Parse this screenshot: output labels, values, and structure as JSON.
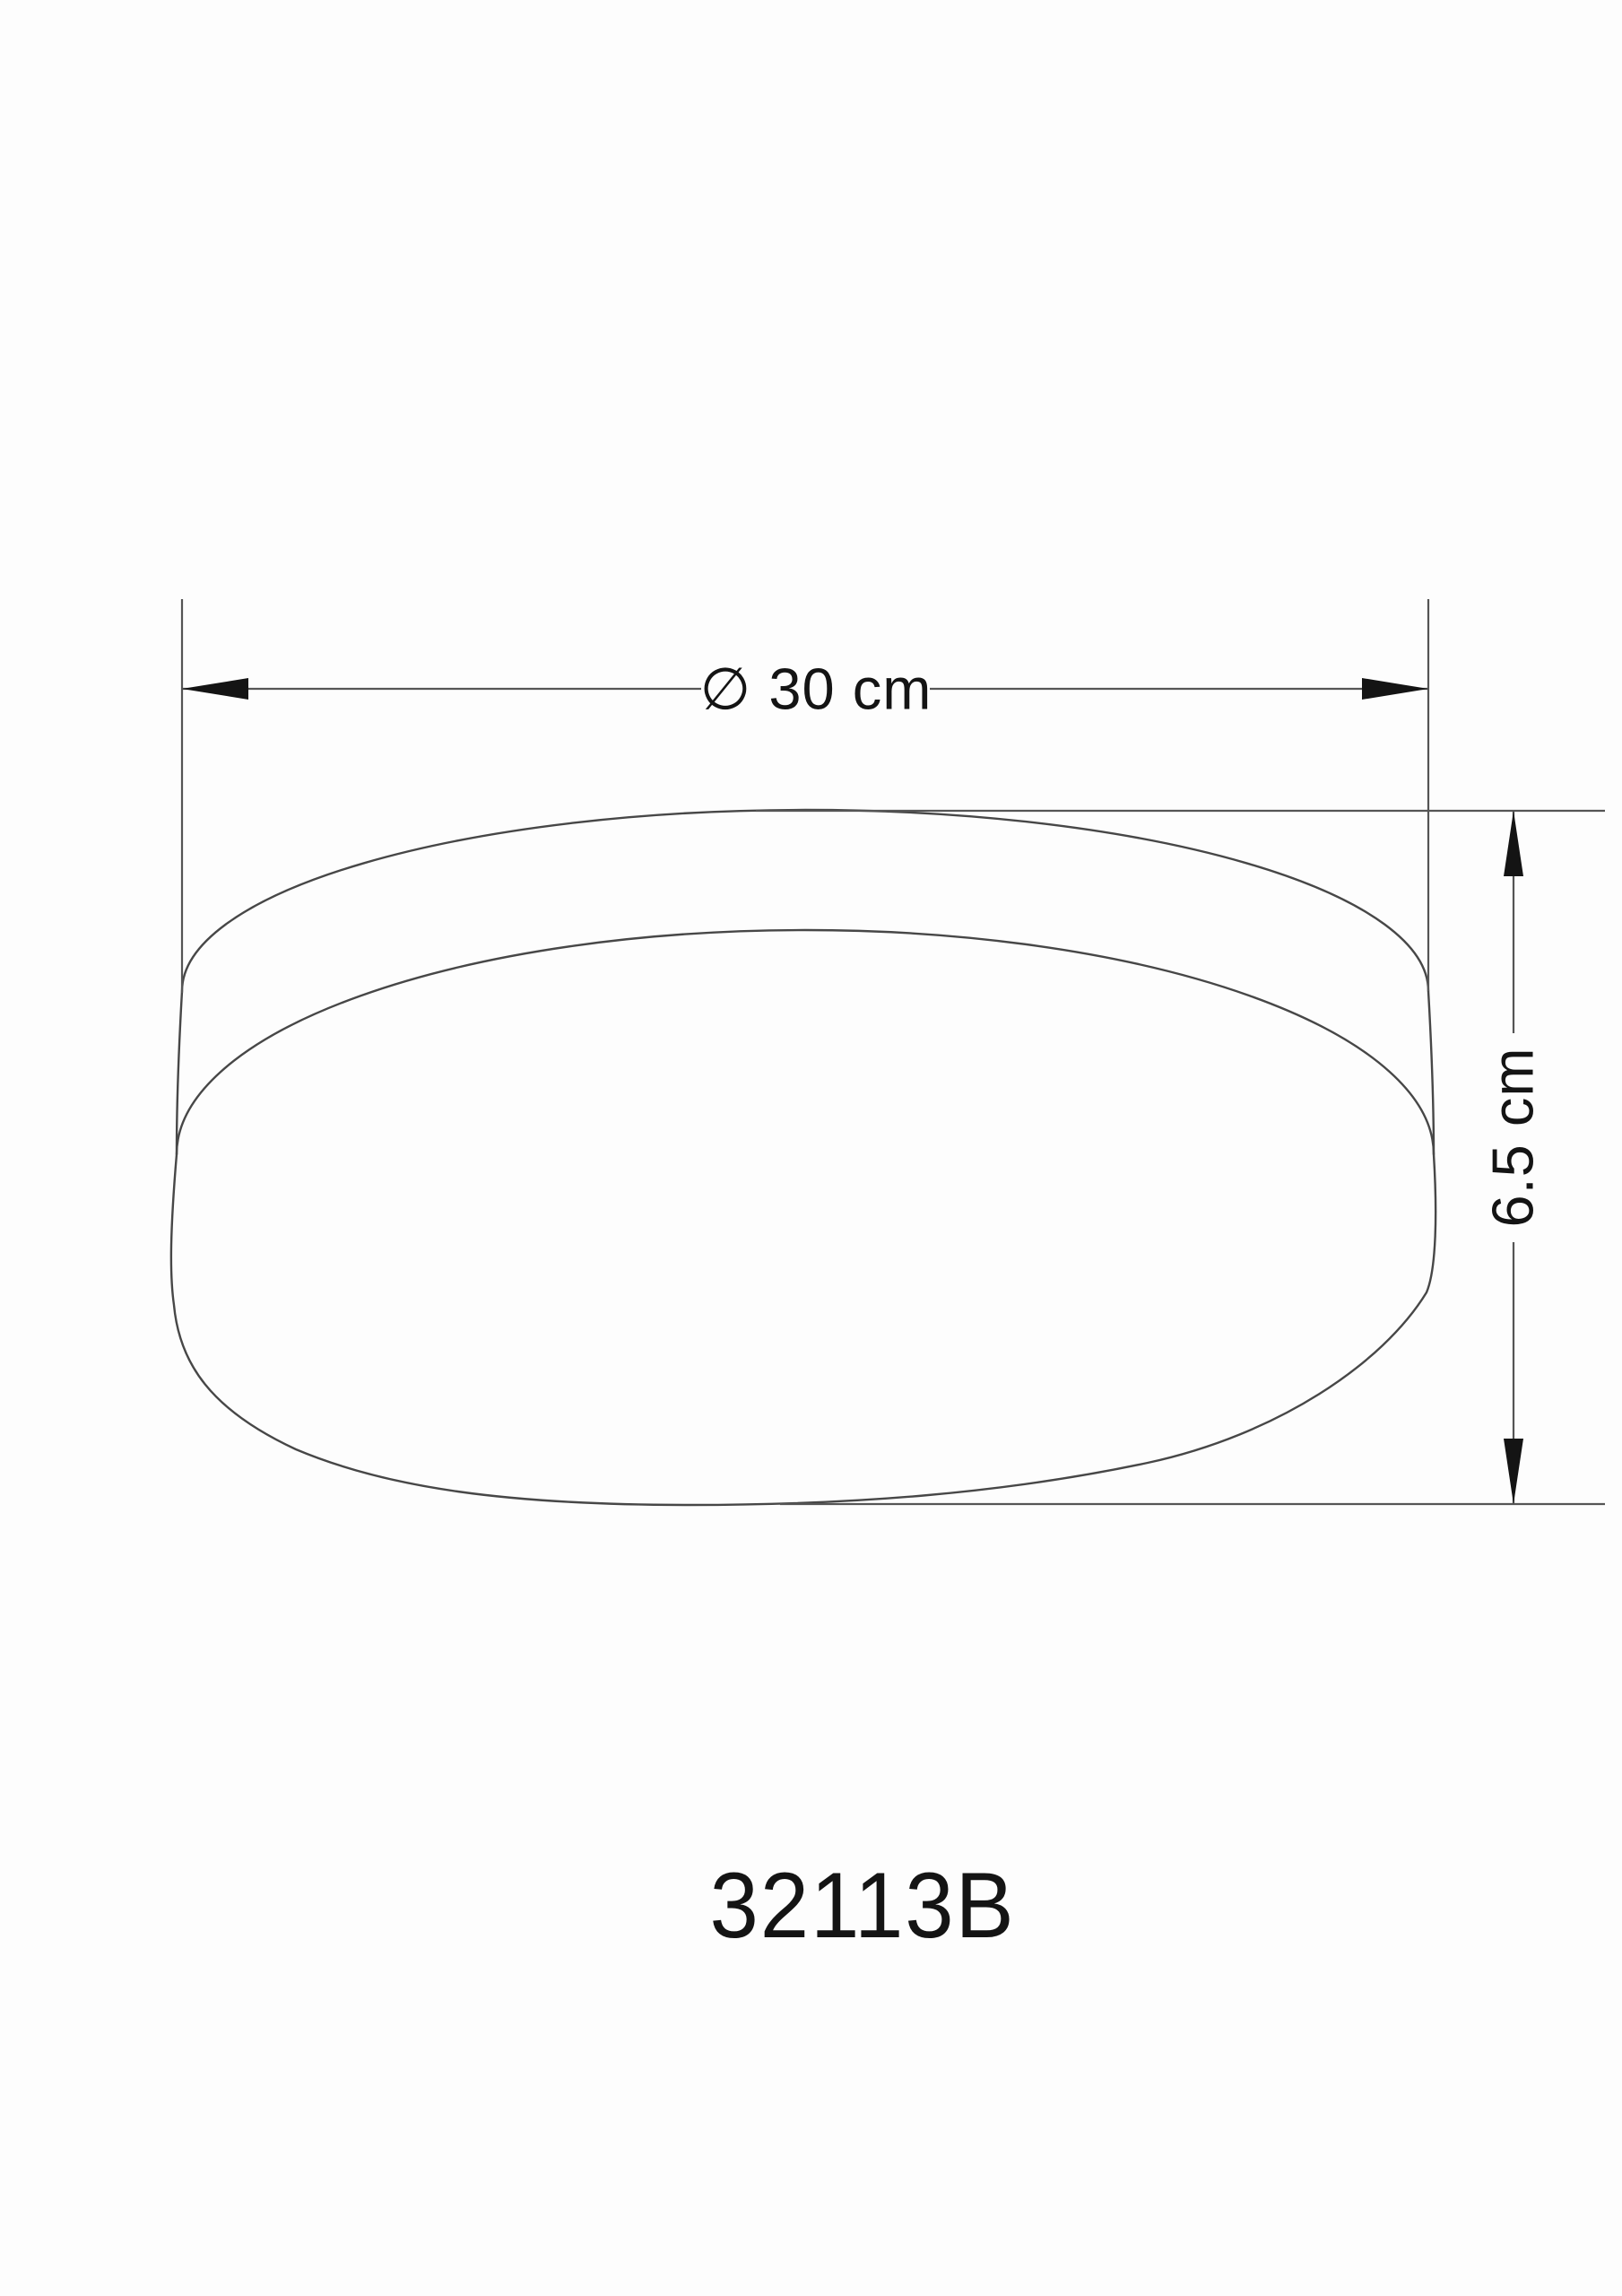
{
  "drawing": {
    "model_label": "32113B",
    "dimensions": {
      "diameter": {
        "label": "∅ 30 cm",
        "value": 30,
        "unit": "cm"
      },
      "height": {
        "label": "6.5 cm",
        "value": 6.5,
        "unit": "cm"
      }
    },
    "colors": {
      "background": "#fdfdfd",
      "lamp_outline": "#474747",
      "dimension_lines": "#555555",
      "text_and_arrows": "#141414"
    }
  }
}
